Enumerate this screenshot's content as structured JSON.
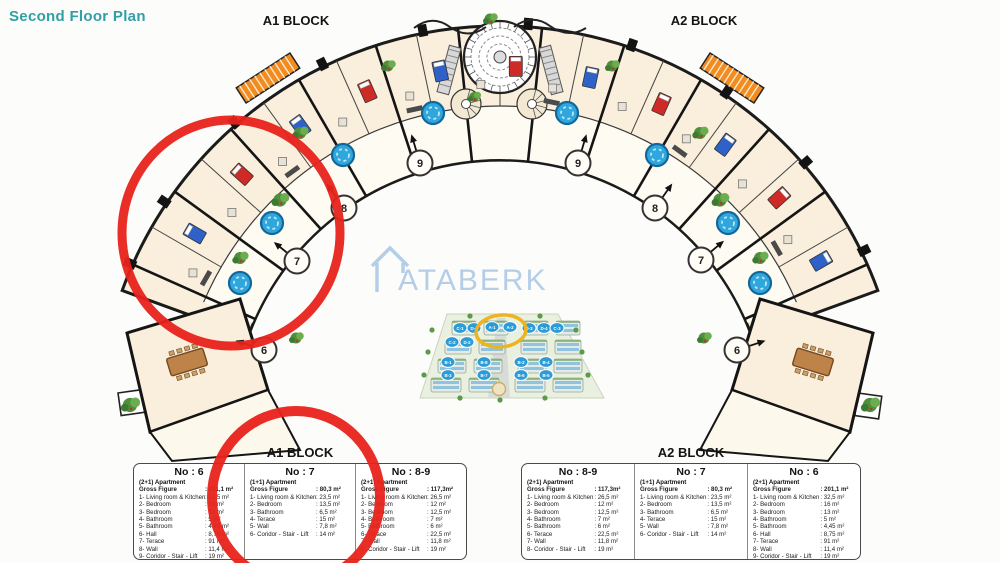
{
  "header": {
    "title": "Second Floor Plan"
  },
  "plan": {
    "block_labels": {
      "a1": "A1 BLOCK",
      "a2": "A2 BLOCK"
    },
    "unit_markers": [
      "6",
      "7",
      "8",
      "9"
    ],
    "watermark": {
      "text": "ATABERK"
    },
    "colors": {
      "title_teal": "#2FA0A5",
      "annotation_red": "#E8221B",
      "highlight_yellow": "#EDB41F",
      "room_fill": "#FAEFDC",
      "jacuzzi_blue": "#2FA6DC",
      "ramp_orange": "#F28C1E"
    }
  },
  "site_render": {
    "markers": [
      "C-1",
      "D-1",
      "A-1",
      "A-2",
      "D-3",
      "D-4",
      "C-3",
      "C-2",
      "D-2",
      "B-1",
      "B-8",
      "B-2",
      "B-4",
      "B-3",
      "B-7",
      "B-6",
      "B-5"
    ]
  },
  "tables": {
    "a1": {
      "title": "A1 BLOCK",
      "columns": [
        {
          "no": "No : 6",
          "type": "(2+1) Apartment",
          "gross_label": "Gross Figure",
          "gross_value": ": 201,1 m²",
          "rows": [
            {
              "label": "1- Living room & Kitchen",
              "value": ": 32,5 m²"
            },
            {
              "label": "2- Bedroom",
              "value": ": 16 m²"
            },
            {
              "label": "3- Bedroom",
              "value": ": 13 m²"
            },
            {
              "label": "4- Bathroom",
              "value": ": 5 m²"
            },
            {
              "label": "5- Bathroom",
              "value": ": 4,45 m²"
            },
            {
              "label": "6- Hall",
              "value": ": 8,75 m²"
            },
            {
              "label": "7- Terace",
              "value": ": 91 m²"
            },
            {
              "label": "8- Wall",
              "value": ": 11,4 m²"
            },
            {
              "label": "9- Coridor - Stair - Lift",
              "value": ": 19 m²"
            }
          ]
        },
        {
          "no": "No : 7",
          "type": "(1+1) Apartment",
          "gross_label": "Gross Figure",
          "gross_value": ": 80,3 m²",
          "rows": [
            {
              "label": "1- Living room & Kitchen",
              "value": ": 23,5 m²"
            },
            {
              "label": "2- Bedroom",
              "value": ": 13,5 m²"
            },
            {
              "label": "3- Bathroom",
              "value": ": 6,5 m²"
            },
            {
              "label": "4- Terace",
              "value": ": 15 m²"
            },
            {
              "label": "5- Wall",
              "value": ": 7,8 m²"
            },
            {
              "label": "6- Coridor - Stair - Lift",
              "value": ": 14 m²"
            }
          ]
        },
        {
          "no": "No : 8-9",
          "type": "(2+1) Apartment",
          "gross_label": "Gross Figure",
          "gross_value": ": 117,3m²",
          "rows": [
            {
              "label": "1- Living room & Kitchen",
              "value": ": 26,5 m²"
            },
            {
              "label": "2- Bedroom",
              "value": ": 12 m²"
            },
            {
              "label": "3- Bedroom",
              "value": ": 12,5 m²"
            },
            {
              "label": "4- Bathroom",
              "value": ": 7 m²"
            },
            {
              "label": "5- Bathroom",
              "value": ": 6 m²"
            },
            {
              "label": "6- Terace",
              "value": ": 22,5 m²"
            },
            {
              "label": "7- Wall",
              "value": ": 11,8 m²"
            },
            {
              "label": "8- Coridor - Stair - Lift",
              "value": ": 19 m²"
            }
          ]
        }
      ]
    },
    "a2": {
      "title": "A2 BLOCK",
      "columns": [
        {
          "no": "No : 8-9",
          "type": "(2+1) Apartment",
          "gross_label": "Gross Figure",
          "gross_value": ": 117,3m²",
          "rows": [
            {
              "label": "1- Living room & Kitchen",
              "value": ": 26,5 m²"
            },
            {
              "label": "2- Bedroom",
              "value": ": 12 m²"
            },
            {
              "label": "3- Bedroom",
              "value": ": 12,5 m²"
            },
            {
              "label": "4- Bathroom",
              "value": ": 7 m²"
            },
            {
              "label": "5- Bathroom",
              "value": ": 6 m²"
            },
            {
              "label": "6- Terace",
              "value": ": 22,5 m²"
            },
            {
              "label": "7- Wall",
              "value": ": 11,8 m²"
            },
            {
              "label": "8- Coridor - Stair - Lift",
              "value": ": 19 m²"
            }
          ]
        },
        {
          "no": "No : 7",
          "type": "(1+1) Apartment",
          "gross_label": "Gross Figure",
          "gross_value": ": 80,3 m²",
          "rows": [
            {
              "label": "1- Living room & Kitchen",
              "value": ": 23,5 m²"
            },
            {
              "label": "2- Bedroom",
              "value": ": 13,5 m²"
            },
            {
              "label": "3- Bathroom",
              "value": ": 6,5 m²"
            },
            {
              "label": "4- Terace",
              "value": ": 15 m²"
            },
            {
              "label": "5- Wall",
              "value": ": 7,8 m²"
            },
            {
              "label": "6- Coridor - Stair - Lift",
              "value": ": 14 m²"
            }
          ]
        },
        {
          "no": "No : 6",
          "type": "(2+1) Apartment",
          "gross_label": "Gross Figure",
          "gross_value": ": 201,1 m²",
          "rows": [
            {
              "label": "1- Living room & Kitchen",
              "value": ": 32,5 m²"
            },
            {
              "label": "2- Bedroom",
              "value": ": 16 m²"
            },
            {
              "label": "3- Bedroom",
              "value": ": 13 m²"
            },
            {
              "label": "4- Bathroom",
              "value": ": 5 m²"
            },
            {
              "label": "5- Bathroom",
              "value": ": 4,45 m²"
            },
            {
              "label": "6- Hall",
              "value": ": 8,75 m²"
            },
            {
              "label": "7- Terace",
              "value": ": 91 m²"
            },
            {
              "label": "8- Wall",
              "value": ": 11,4 m²"
            },
            {
              "label": "9- Coridor - Stair - Lift",
              "value": ": 19 m²"
            }
          ]
        }
      ]
    }
  }
}
